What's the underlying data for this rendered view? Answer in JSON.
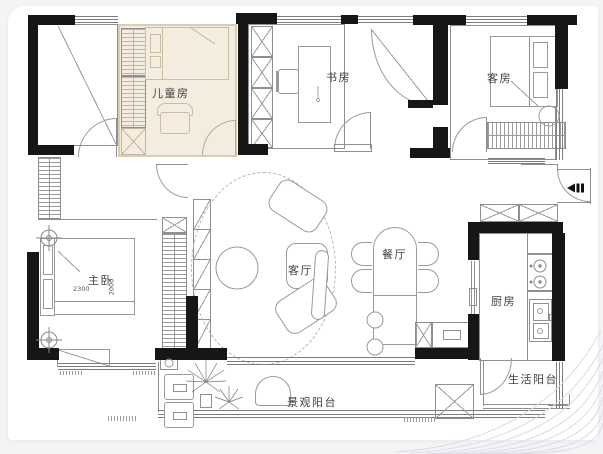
{
  "page": {
    "background": "#f4f4f7",
    "card_color": "#ffffff"
  },
  "plan": {
    "highlight_color": "#f3ecdf",
    "highlight_border": "#d9cdb6",
    "wall_color": "#161616",
    "line_color": "#8f8f8f",
    "rooms": {
      "children_room": {
        "label": "儿童房",
        "highlighted": true
      },
      "study": {
        "label": "书房"
      },
      "guest_room": {
        "label": "客房"
      },
      "master_bedroom": {
        "label": "主卧",
        "bed_width_mm": "2300",
        "bed_depth_mm": "2000"
      },
      "living_room": {
        "label": "客厅"
      },
      "dining_room": {
        "label": "餐厅"
      },
      "kitchen": {
        "label": "厨房"
      },
      "service_balcony": {
        "label": "生活阳台"
      },
      "view_balcony": {
        "label": "景观阳台"
      }
    },
    "icons": {
      "entry": "entry-door-icon",
      "ceiling_lamp": "ceiling-lamp-icon",
      "plant": "plant-icon",
      "stove": "stove-icon",
      "sink": "sink-icon"
    }
  }
}
